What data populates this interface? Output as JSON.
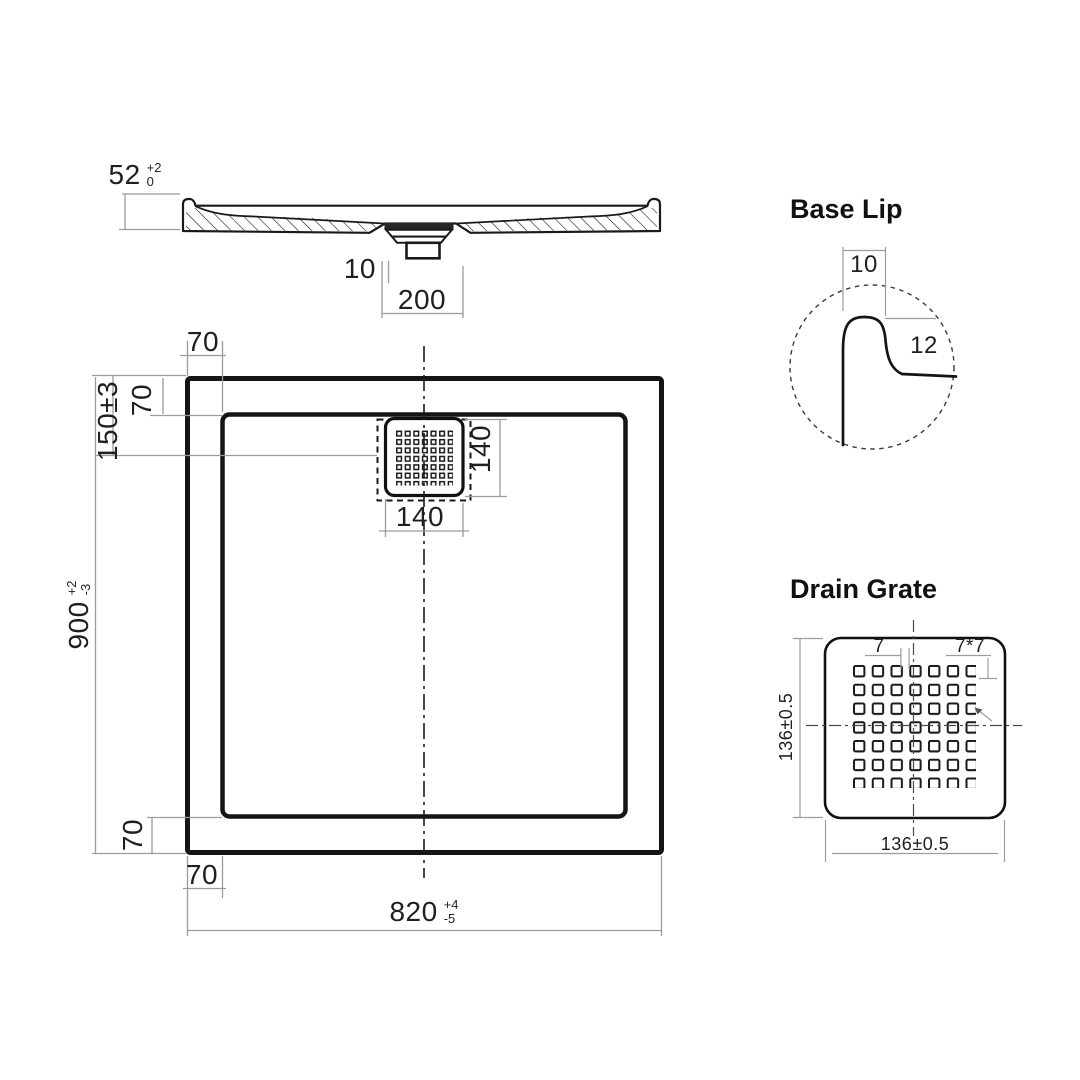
{
  "colors": {
    "line": "#1a1a1a",
    "dimension_line": "#9c9c9c",
    "text": "#1f1f1f",
    "background": "#ffffff"
  },
  "section_view": {
    "height": {
      "value": "52",
      "tol_top": "+2",
      "tol_bottom": "0"
    },
    "lip_offset": "10",
    "drain_recess_width": "200"
  },
  "plan_view": {
    "top_wall": "70",
    "left_wall": "70",
    "drain_center_from_top": "150±3",
    "overall_length": {
      "value": "900",
      "tol_top": "+2",
      "tol_bottom": "-3"
    },
    "bottom_wall": "70",
    "bottom_ledge": "70",
    "overall_width": {
      "value": "820",
      "tol_top": "+4",
      "tol_bottom": "-5"
    },
    "grate_height": "140",
    "grate_width": "140"
  },
  "base_lip_detail": {
    "title": "Base Lip",
    "lip_width": "10",
    "lip_height": "12"
  },
  "drain_grate_detail": {
    "title": "Drain Grate",
    "slot_gap": "7",
    "slot_size": "7*7",
    "height": "136±0.5",
    "width": "136±0.5"
  }
}
